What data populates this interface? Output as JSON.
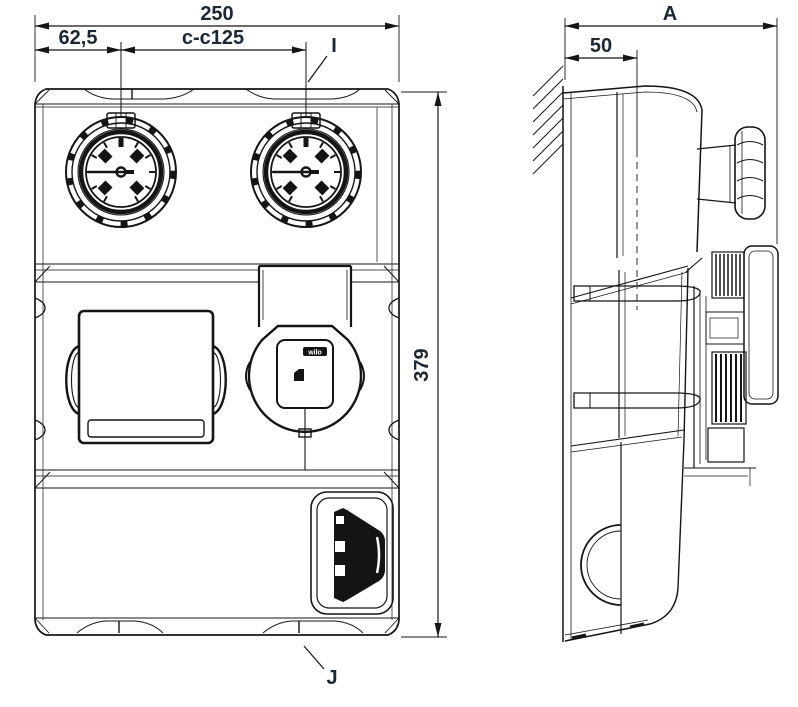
{
  "meta": {
    "type": "technical-dimension-drawing",
    "views": [
      "front",
      "side"
    ]
  },
  "front_view": {
    "dims": {
      "overall_width": "250",
      "left_offset": "62,5",
      "center_to_center": "c-c125",
      "height": "379"
    },
    "labels": {
      "top_callout": "I",
      "bottom_callout": "J"
    },
    "pump": {
      "brand": "wilo"
    }
  },
  "side_view": {
    "dims": {
      "overall_depth": "A",
      "wall_offset": "50"
    }
  },
  "colors": {
    "line": "#151515",
    "dim_text": "#1c2733",
    "background": "#ffffff"
  }
}
